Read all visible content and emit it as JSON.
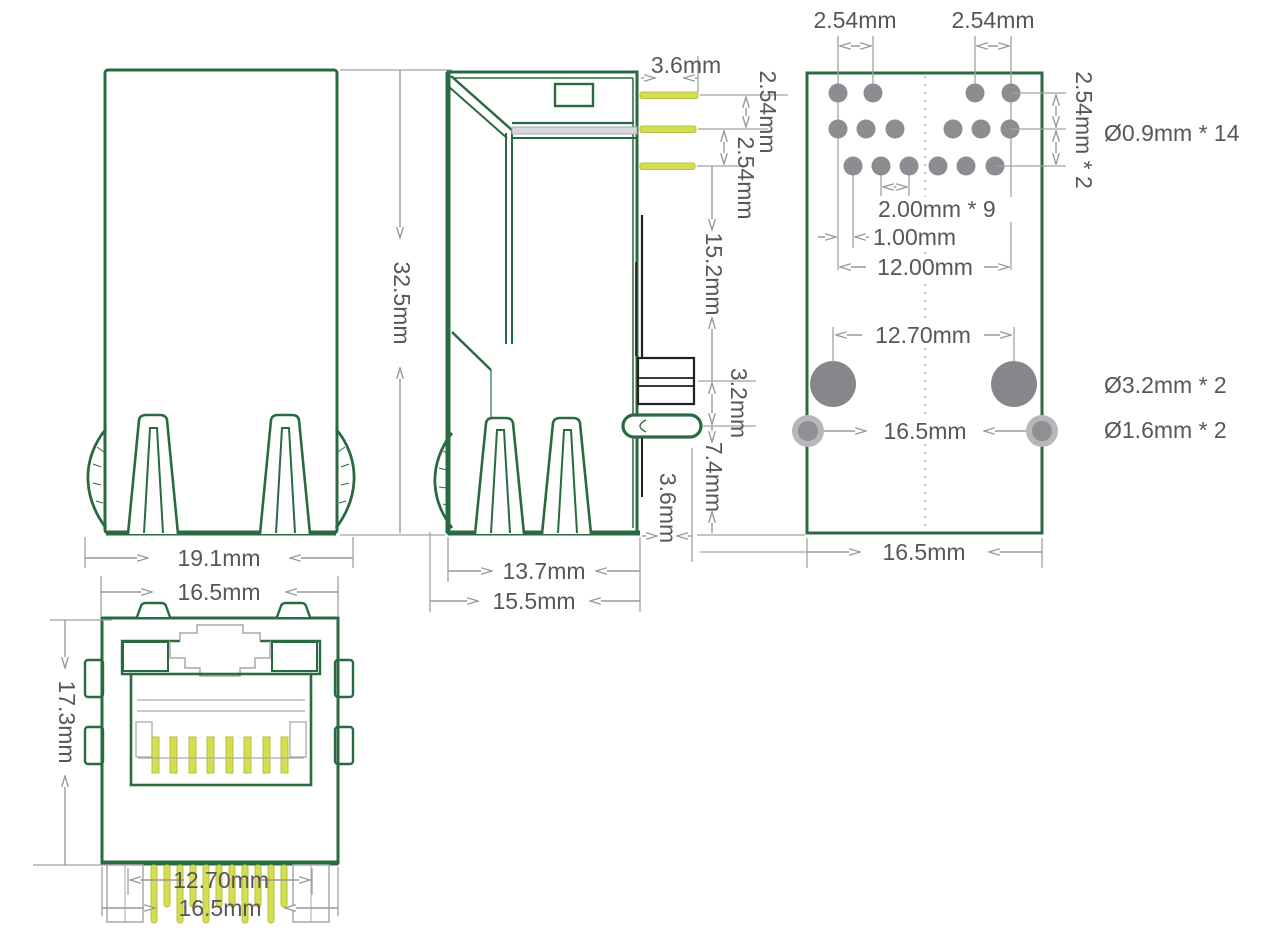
{
  "drawing": {
    "left_view": {
      "height": "32.5mm",
      "outer_width": "19.1mm",
      "shield_width": "16.5mm"
    },
    "side_view": {
      "pin_length": "3.6mm",
      "pin_pitch_top": "2.54mm",
      "pin_pitch_bottom": "2.54mm",
      "body_height": "15.2mm",
      "tab_height": "3.2mm",
      "post_height": "7.4mm",
      "rear_offset": "3.6mm",
      "leg_span": "13.7mm",
      "depth": "15.5mm"
    },
    "front_view": {
      "height": "17.3mm",
      "tab_span": "12.70mm",
      "width": "16.5mm"
    },
    "footprint": {
      "led_pitch_left": "2.54mm",
      "led_pitch_right": "2.54mm",
      "row_pitch": "2.54mm * 2",
      "signal_hole_spec": "Ø0.9mm *  14",
      "signal_pitch": "2.00mm * 9",
      "row_offset": "1.00mm",
      "signal_span": "12.00mm",
      "post_span": "12.70mm",
      "shield_pitch": "16.5mm",
      "post_hole_spec": "Ø3.2mm *  2",
      "shield_hole_spec": "Ø1.6mm *  2",
      "width": "16.5mm"
    },
    "colors": {
      "outline_green": "#2a6a40",
      "pin_yellow": "#d5dd50",
      "led_green": "#63b944",
      "led_yellow": "#c6d64a",
      "dimension_gray": "#97999c",
      "text_gray": "#55575a",
      "hole_gray": "#8b8d90",
      "pad_gray": "#b5b7b9",
      "black": "#231f20"
    }
  }
}
